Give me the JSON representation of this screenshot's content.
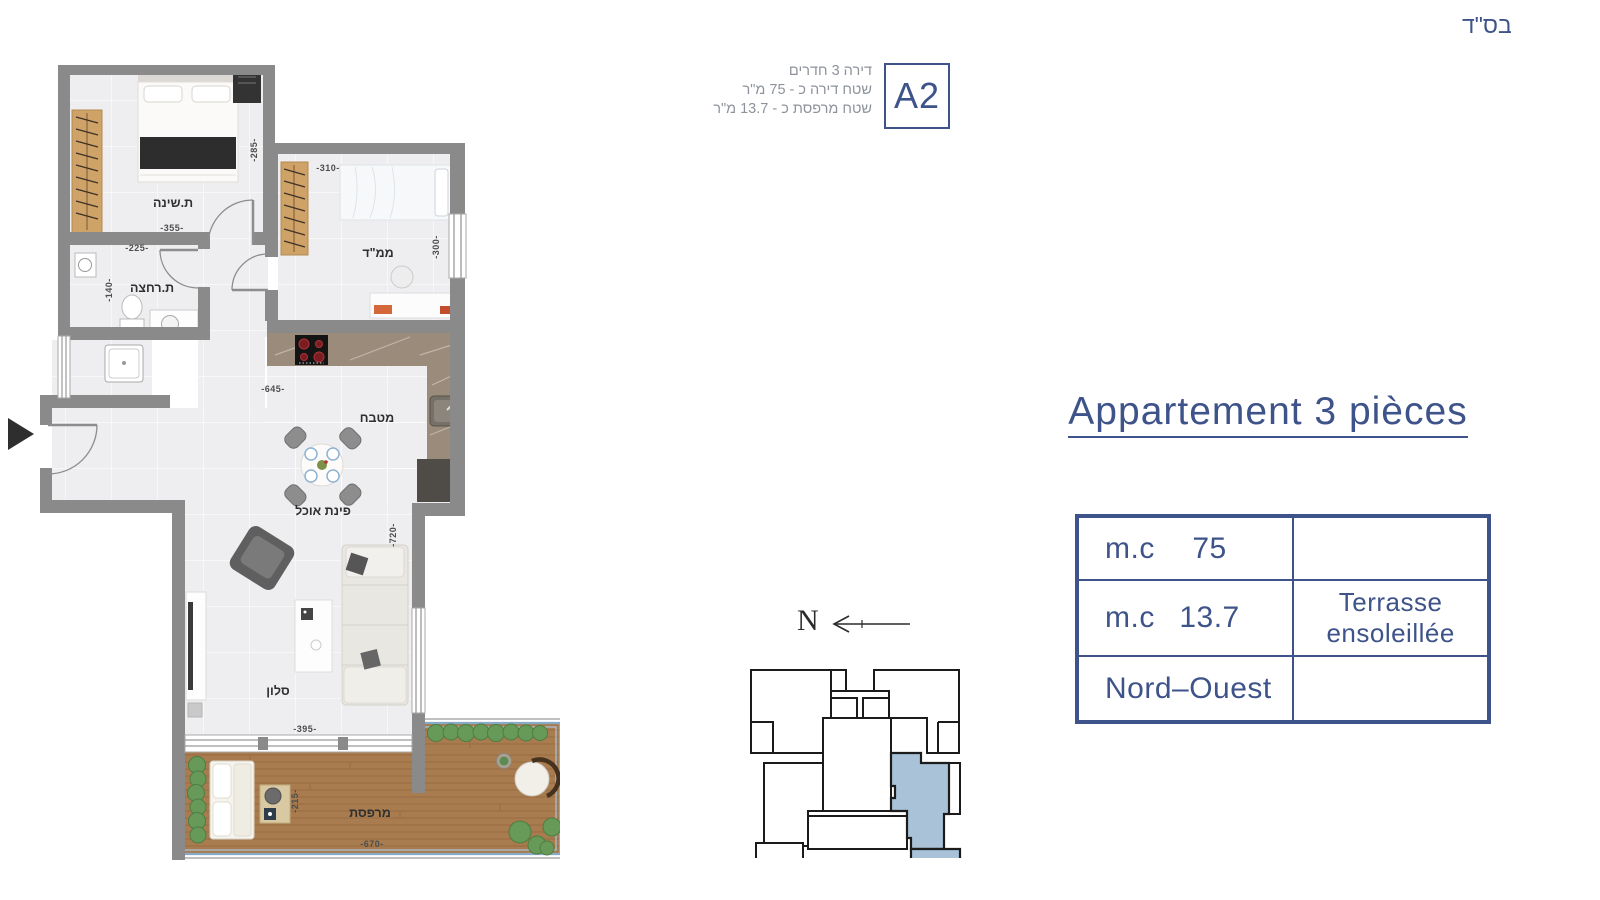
{
  "meta": {
    "bsd": "בס\"ד"
  },
  "header": {
    "unit": "A2",
    "lines": [
      "דירה 3 חדרים",
      "שטח דירה כ - 75 מ\"ר",
      "שטח מרפסת כ - 13.7 מ\"ר"
    ]
  },
  "panel": {
    "title": "Appartement 3 pièces",
    "table": {
      "rows": [
        {
          "label": "m.c",
          "value": "75",
          "right": ""
        },
        {
          "label": "m.c",
          "value": "13.7",
          "right": "Terrasse ensoleillée"
        },
        {
          "label": "Nord–Ouest",
          "value": "",
          "right": ""
        }
      ]
    }
  },
  "compass": {
    "label": "N"
  },
  "plan": {
    "rooms": {
      "bedroom": "ת.שינה",
      "safe_room": "ממ\"ד",
      "bathroom": "ת.רחצה",
      "kitchen": "מטבח",
      "dining": "פינת אוכל",
      "living": "סלון",
      "terrace": "מרפסת"
    },
    "dims": {
      "bedroom_w": "-355-",
      "bedroom_h": "-285-",
      "safe_room_w": "-310-",
      "safe_room_h": "-300-",
      "bath_w": "-225-",
      "bath_h": "-140-",
      "kitchen_w": "-645-",
      "living_h": "-720-",
      "living_w": "-395-",
      "terrace_w": "-670-",
      "terrace_h": "-215-"
    }
  },
  "colors": {
    "accent_blue": "#3e5389",
    "header_gray": "#8e939b",
    "wall_gray": "#8a8a8a",
    "floor": "#eeeef0",
    "wood": "#cfa268",
    "deck": "#a87c4f",
    "hedge_green": "#679a58",
    "railing_blue": "#85abc9",
    "keyplan_highlight": "#a9c2d8"
  }
}
